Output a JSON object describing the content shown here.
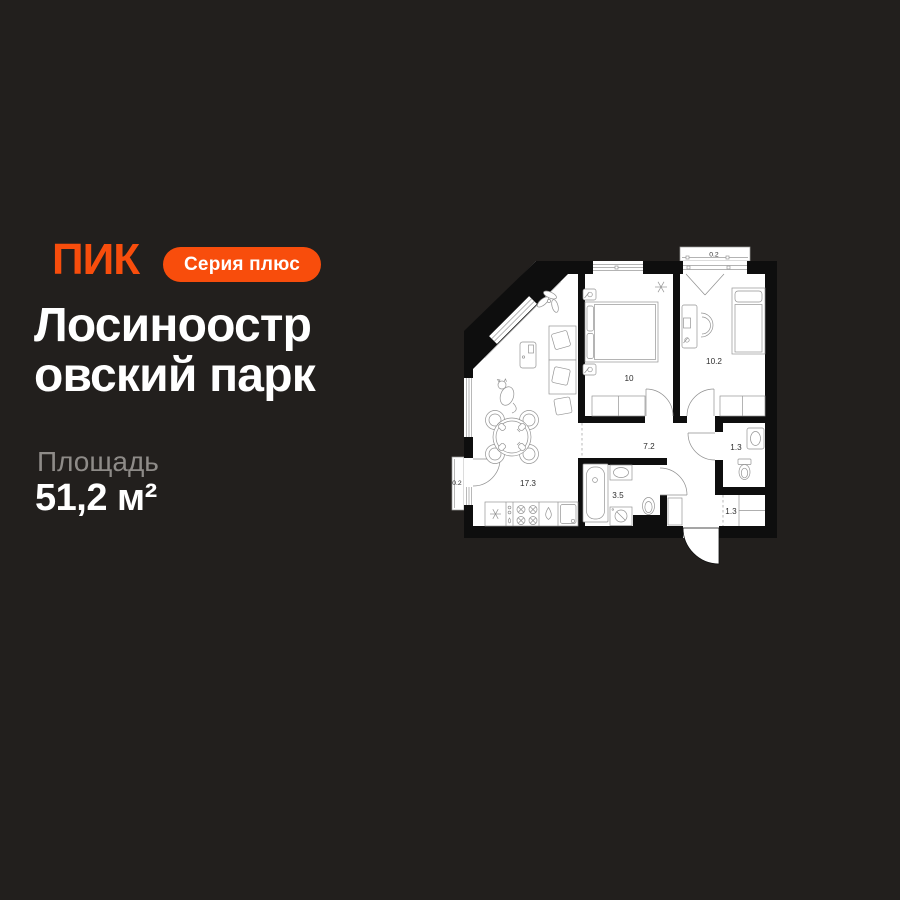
{
  "page": {
    "background": "#221F1D",
    "accent": "#F84D0C"
  },
  "header": {
    "logo": "ПИК",
    "badge": "Серия плюс"
  },
  "title": {
    "full": "Лосиноостровский парк",
    "line1": "Лосиноостр",
    "line2": "овский парк"
  },
  "area": {
    "label": "Площадь",
    "value": "51,2 м²"
  },
  "floorplan": {
    "total_area": "51.2",
    "rooms": [
      {
        "name": "living-kitchen",
        "area": "17.3"
      },
      {
        "name": "bedroom-1",
        "area": "10"
      },
      {
        "name": "bedroom-2",
        "area": "10.2"
      },
      {
        "name": "hallway",
        "area": "7.2"
      },
      {
        "name": "bathroom",
        "area": "3.5"
      },
      {
        "name": "wc",
        "area": "1.3"
      },
      {
        "name": "storage",
        "area": "1.3"
      },
      {
        "name": "balcony-top",
        "area": "0.2"
      },
      {
        "name": "balcony-left",
        "area": "0.2"
      }
    ]
  }
}
